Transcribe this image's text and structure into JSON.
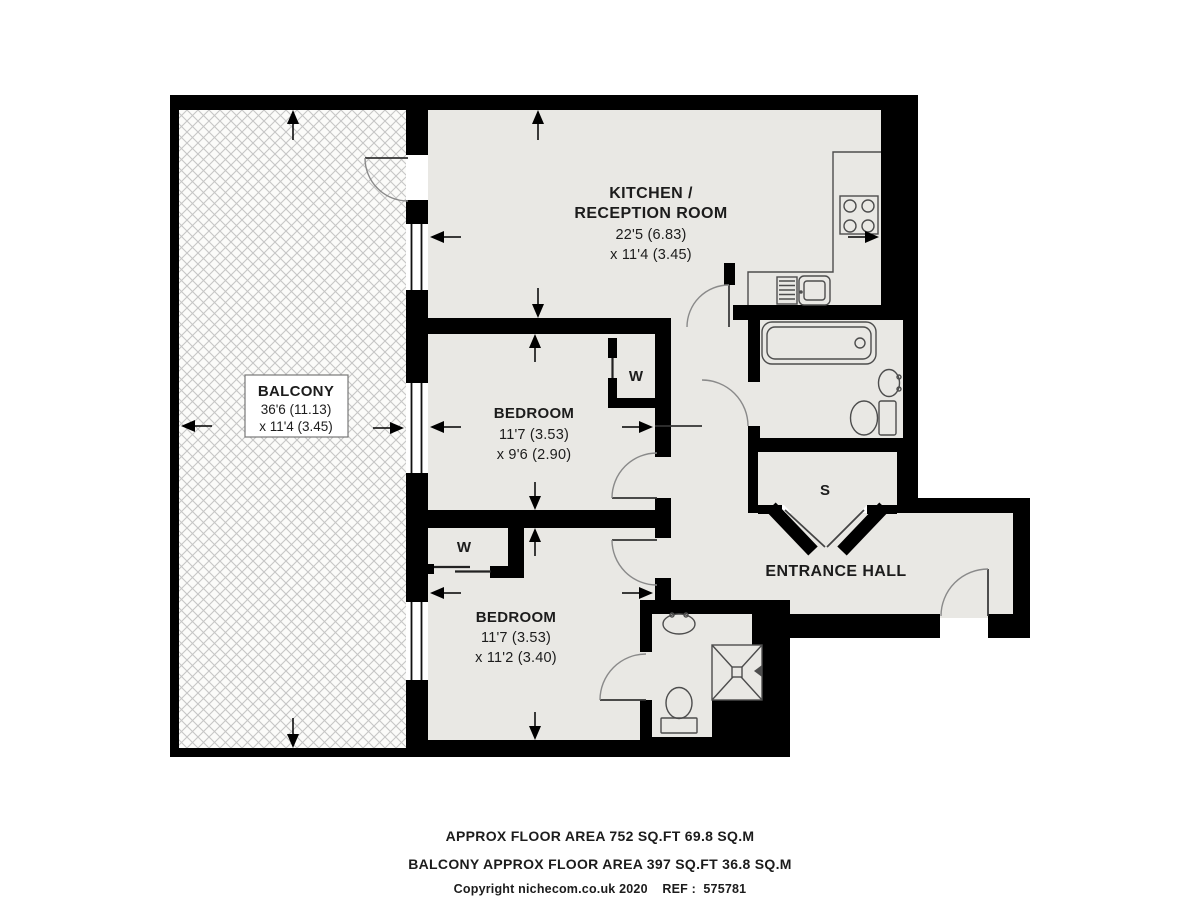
{
  "plan": {
    "balcony": {
      "name": "BALCONY",
      "dim1": "36'6 (11.13)",
      "dim2": "x 11'4 (3.45)"
    },
    "kitchen_reception": {
      "name1": "KITCHEN /",
      "name2": "RECEPTION ROOM",
      "dim1": "22'5 (6.83)",
      "dim2": "x 11'4 (3.45)"
    },
    "bedroom_1": {
      "name": "BEDROOM",
      "dim1": "11'7 (3.53)",
      "dim2": "x 9'6 (2.90)"
    },
    "bedroom_2": {
      "name": "BEDROOM",
      "dim1": "11'7 (3.53)",
      "dim2": "x 11'2 (3.40)"
    },
    "entrance_hall": {
      "name": "ENTRANCE HALL"
    },
    "storage_cupboard": {
      "label": "S"
    },
    "wardrobe_1": {
      "label": "W"
    },
    "wardrobe_2": {
      "label": "W"
    }
  },
  "footer": {
    "area_line": "APPROX FLOOR AREA 752 SQ.FT 69.8 SQ.M",
    "balcony_area_line": "BALCONY APPROX FLOOR AREA 397 SQ.FT 36.8 SQ.M",
    "copyright_line": "Copyright nichecom.co.uk 2020    REF :  575781"
  },
  "colors": {
    "wall": "#000000",
    "floor": "#e9e8e4",
    "hatch_line": "#c6c6c6",
    "hatch_bg": "#fbfbf9",
    "text": "#1c1c1c",
    "fixture": "#4d4d4d",
    "door_arc": "#8a8a8a"
  }
}
